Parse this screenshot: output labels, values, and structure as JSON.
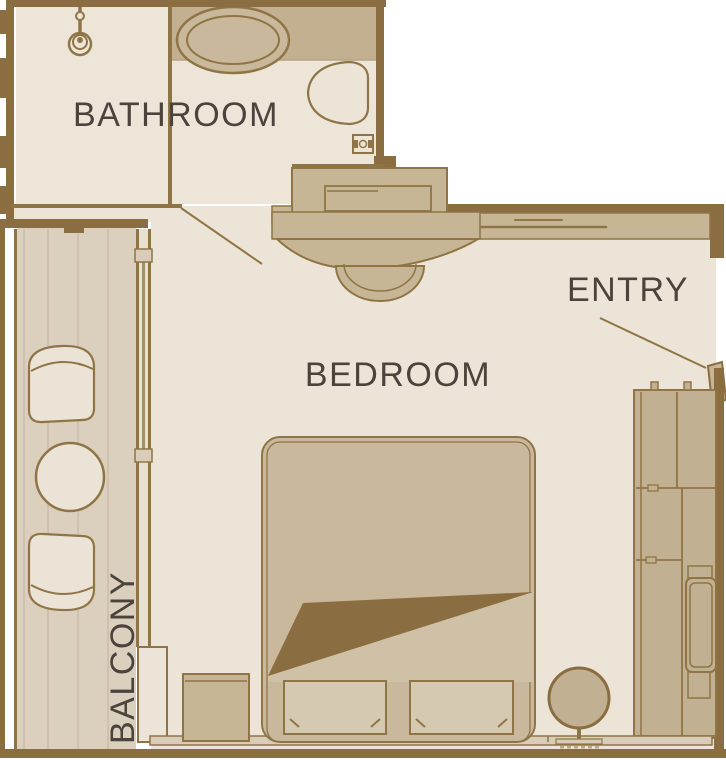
{
  "rooms": {
    "bathroom": {
      "label": "BATHROOM"
    },
    "bedroom": {
      "label": "BEDROOM"
    },
    "entry": {
      "label": "ENTRY"
    },
    "balcony": {
      "label": "BALCONY"
    }
  },
  "palette": {
    "wall_brown": "#8a6d40",
    "outline_brown": "#8f7546",
    "furniture_tan": "#c7b696",
    "wardrobe_tan": "#c2b092",
    "floor_cream": "#ece4d7",
    "deck_tan": "#dbd0be",
    "fixture_light": "#ebe3d5",
    "pillow_light": "#d6c9b1",
    "label_text": "#4b443c",
    "background": "#ffffff"
  },
  "furniture": [
    "shower",
    "sink",
    "toilet",
    "vanity-desk",
    "vanity-stool",
    "balcony-chair",
    "balcony-table",
    "balcony-chair",
    "wardrobe",
    "double-bed",
    "pillow",
    "pillow",
    "nightstand",
    "standing-mirror"
  ]
}
